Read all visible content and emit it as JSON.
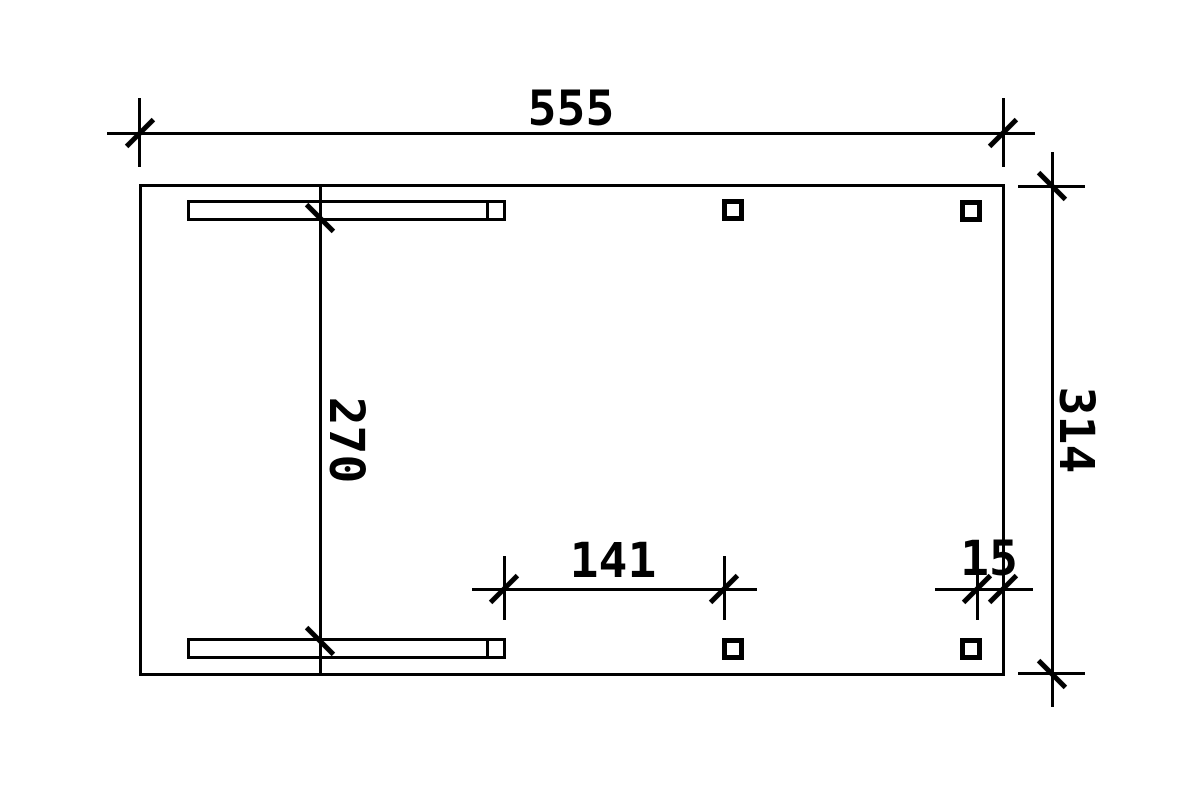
{
  "drawing": {
    "type": "carport-floor-plan",
    "colors": {
      "background": "#ffffff",
      "line": "#000000"
    },
    "dimension_labels": {
      "total_width": "555",
      "total_depth": "314",
      "inner_depth": "270",
      "post_spacing": "141",
      "edge_offset": "15"
    }
  }
}
